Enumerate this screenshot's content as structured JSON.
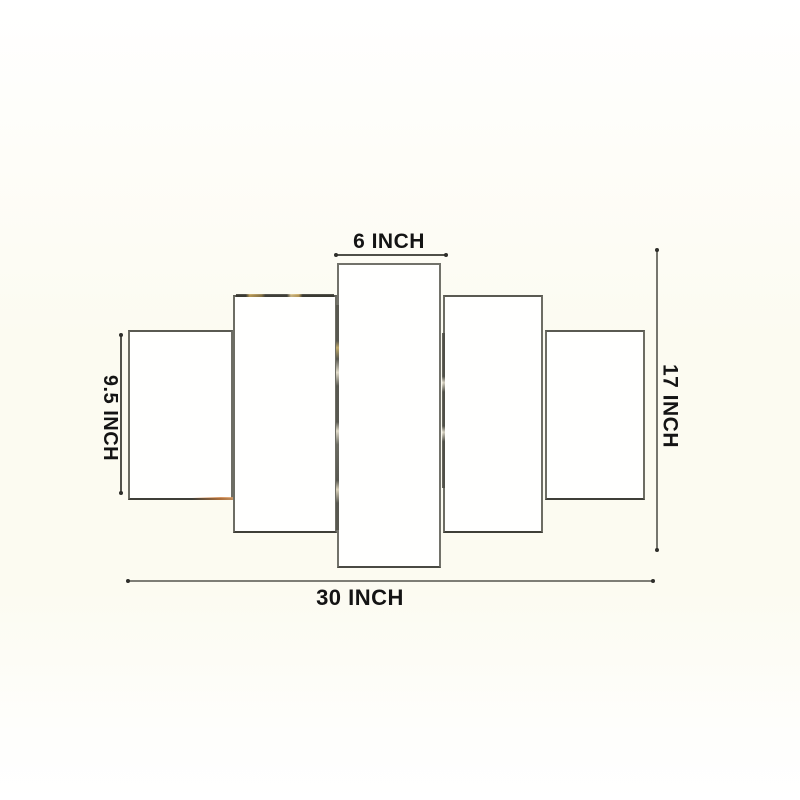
{
  "product_diagram": {
    "type": "5-panel-wall-art-size-diagram",
    "panel_count": 5,
    "panels": [
      {
        "position": "outer-left"
      },
      {
        "position": "mid-left"
      },
      {
        "position": "center"
      },
      {
        "position": "mid-right"
      },
      {
        "position": "outer-right"
      }
    ],
    "labels": {
      "top_width": "6 INCH",
      "left_height": "9.5 INCH",
      "right_height": "17 INCH",
      "bottom_width": "30 INCH"
    },
    "colors": {
      "background_center": "#fcfbf1",
      "background_edge": "#ffffff",
      "panel_fill": "#fffffe",
      "panel_border": "#6d6d64",
      "panel_border_bottom": "#3f3f38",
      "dimension_line_dark": "#4f4f48",
      "dimension_line_light": "#7e7e76",
      "label_text": "#141414",
      "edge_fleck_gold": "#c3a055",
      "edge_fleck_orange": "#c97b3c"
    }
  }
}
